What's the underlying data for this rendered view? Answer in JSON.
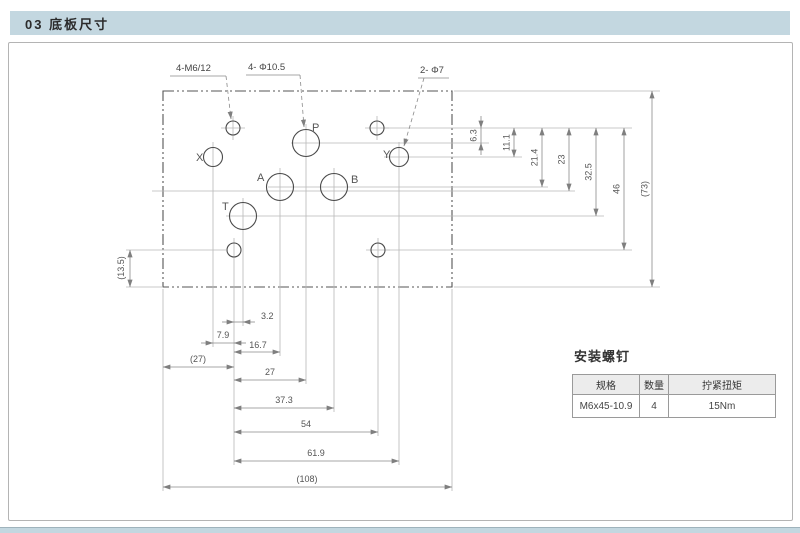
{
  "header": {
    "title": "03 底板尺寸"
  },
  "drawing": {
    "callouts": {
      "m6_thread": "4-M6/12",
      "port_dia": "4- Φ10.5",
      "pilot_dia": "2- Φ7"
    },
    "ports": [
      "P",
      "A",
      "B",
      "T",
      "X",
      "Y"
    ],
    "dims_right": [
      "6.3",
      "11.1",
      "21.4",
      "23",
      "32.5",
      "46",
      "(73)"
    ],
    "dims_left": [
      "(13.5)"
    ],
    "dims_bottom": [
      "3.2",
      "7.9",
      "16.7",
      "(27)",
      "27",
      "37.3",
      "54",
      "61.9",
      "(108)"
    ]
  },
  "screw_table": {
    "title": "安装螺钉",
    "headers": [
      "规格",
      "数量",
      "拧紧扭矩"
    ],
    "rows": [
      [
        "M6x45-10.9",
        "4",
        "15Nm"
      ]
    ]
  },
  "colors": {
    "band": "#c3d7e0",
    "line_dark": "#4a4a4a",
    "line_dim": "#8a8a8a",
    "line_ext": "#b8b8b8",
    "text_dim": "#555555"
  }
}
